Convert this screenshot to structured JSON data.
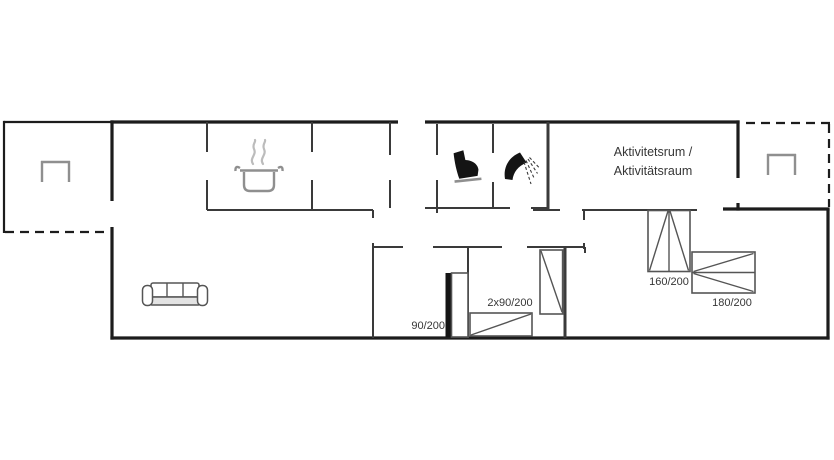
{
  "plan": {
    "activity_room": {
      "line1": "Aktivitetsrum /",
      "line2": "Aktivitätsraum"
    },
    "bed_labels": {
      "single_90": "90/200",
      "double_2x90": "2x90/200",
      "double_160": "160/200",
      "double_180": "180/200"
    },
    "icons": {
      "sofa": "sofa-icon",
      "cooking_pot": "cooking-pot-icon",
      "toilet": "toilet-icon",
      "shower": "shower-icon",
      "garden_table_left": "garden-table-icon",
      "garden_table_right": "garden-table-icon"
    },
    "colors": {
      "wall": "#1c1c1c",
      "interior_wall": "#3a3a3a",
      "furniture_line": "#555555",
      "furniture_gray": "#8f8f8f",
      "fixture_black": "#141414",
      "steam_gray": "#bcbcbc",
      "text": "#363636",
      "background": "#ffffff"
    }
  }
}
